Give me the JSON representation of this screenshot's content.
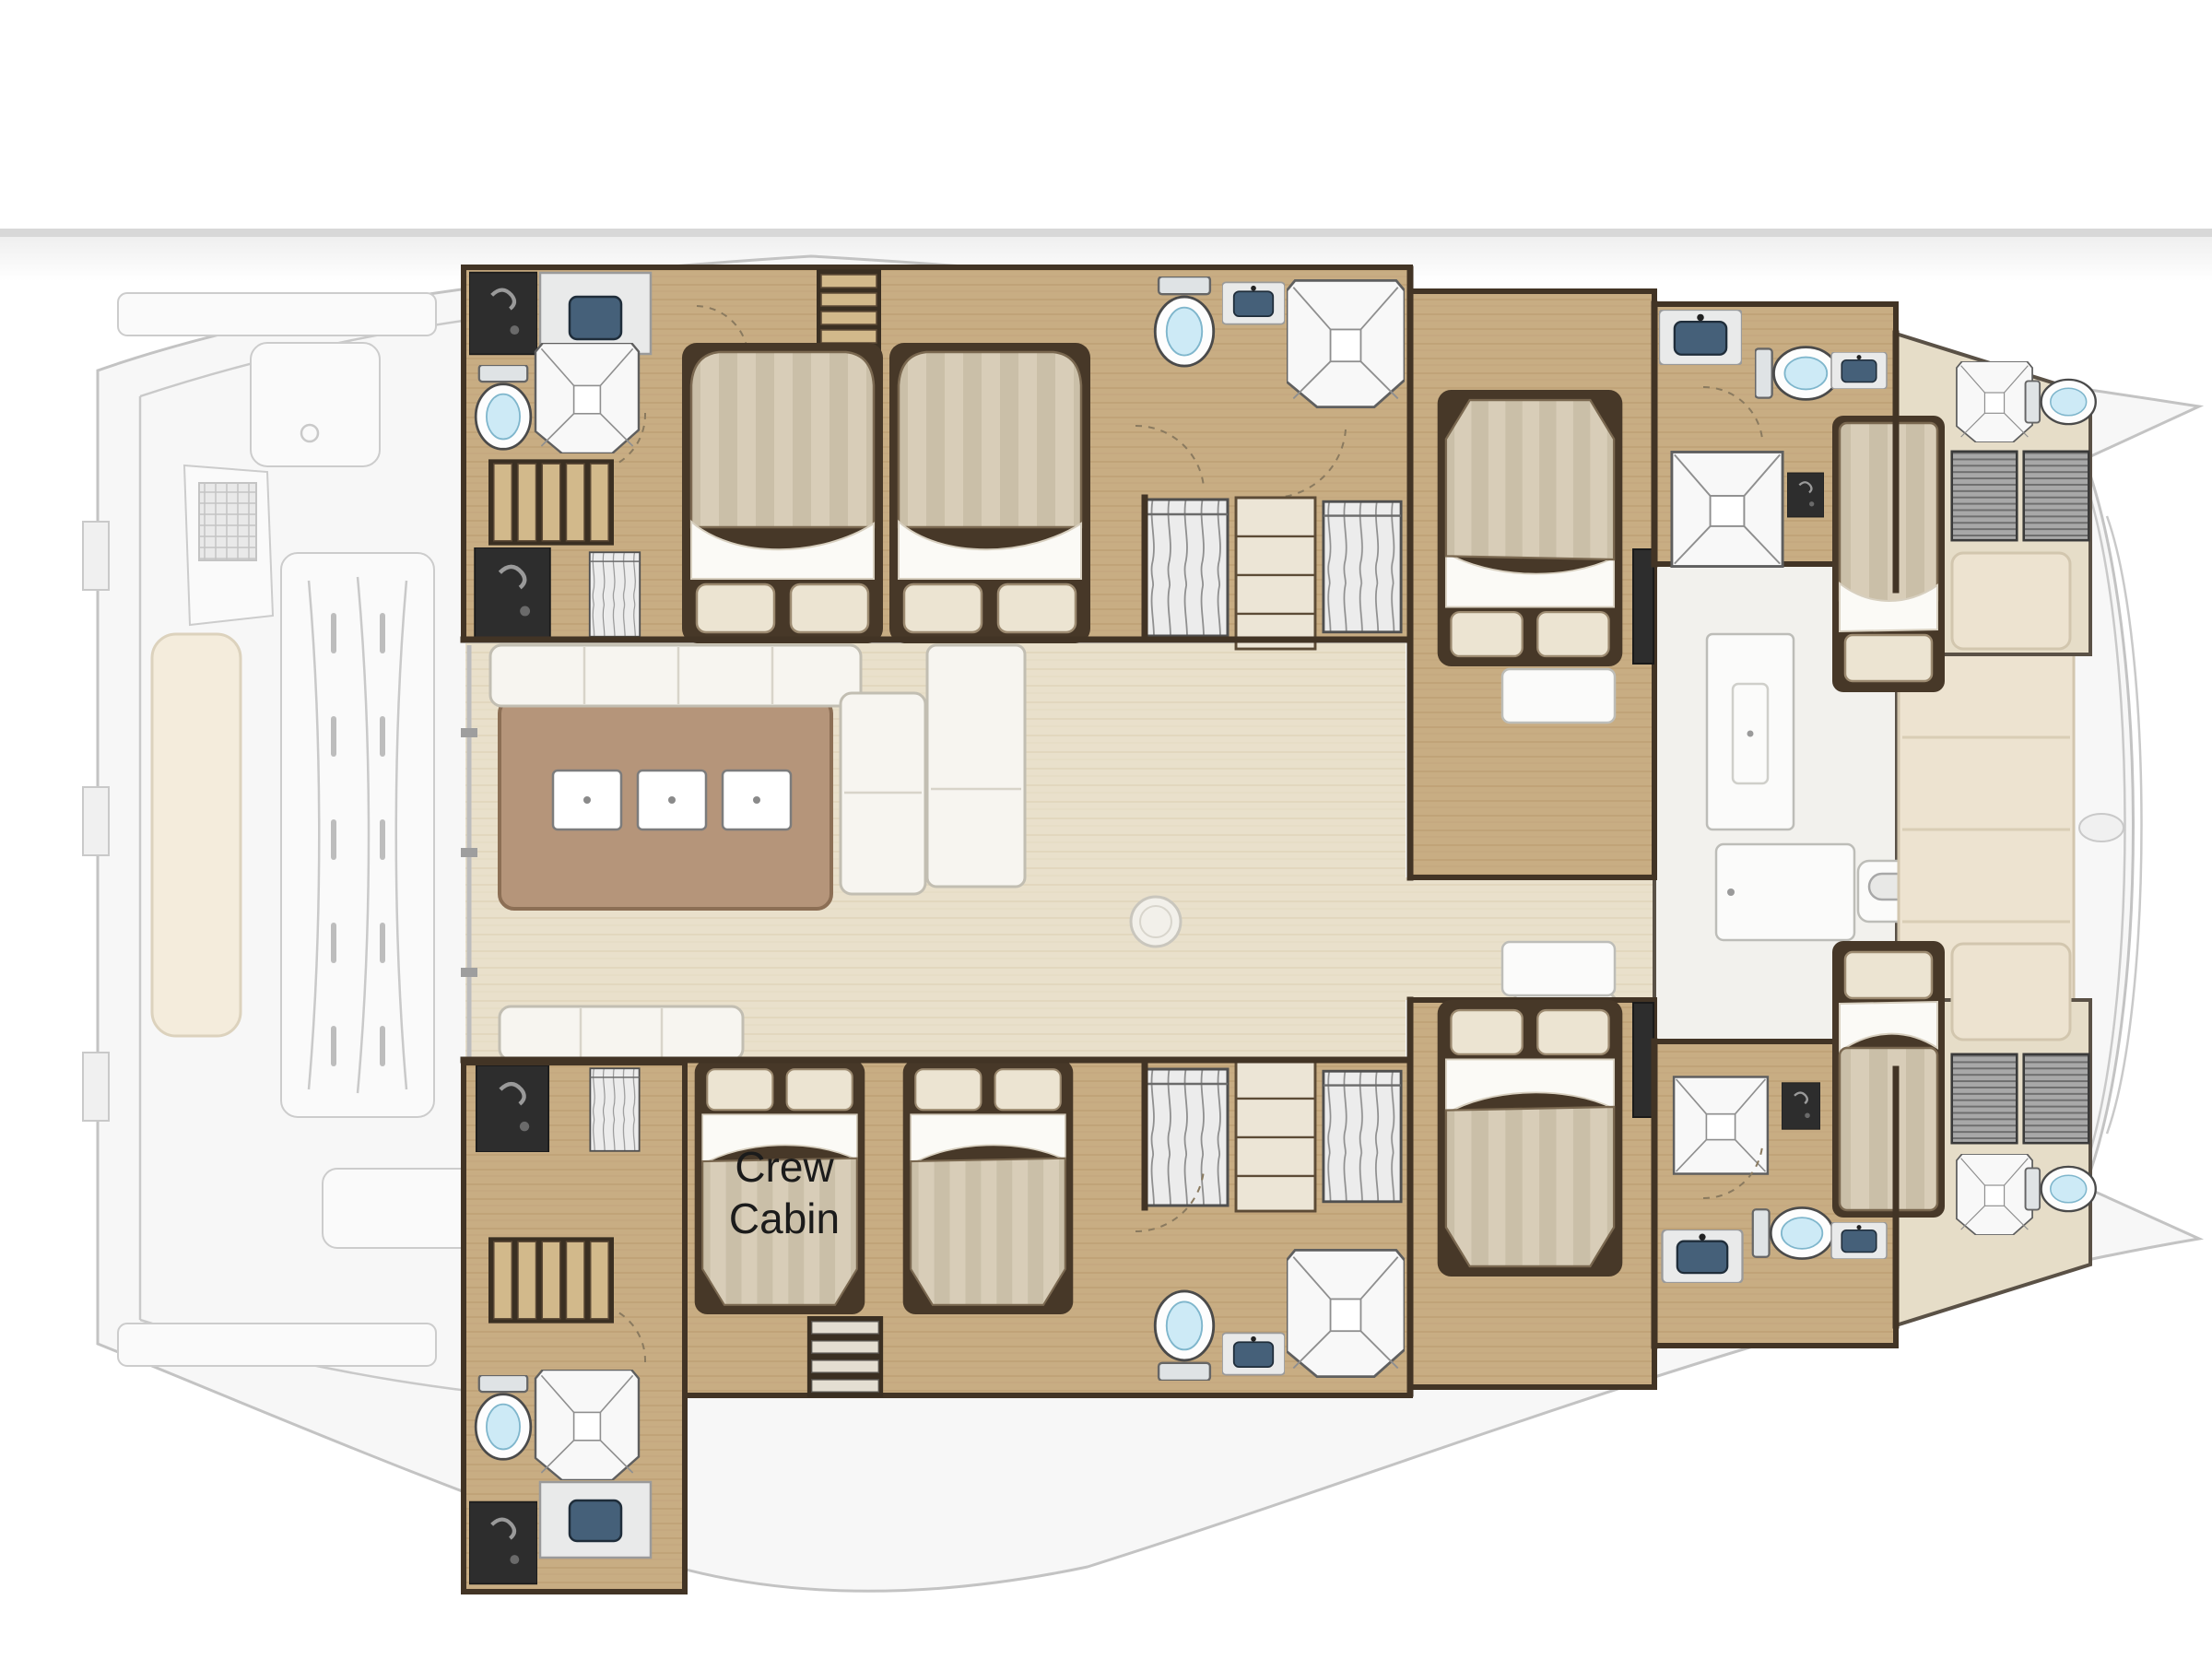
{
  "page": {
    "background": "#ffffff",
    "separator_color": "#d8d8d8"
  },
  "plan": {
    "vessel_type": "catamaran yacht floor plan",
    "labels": {
      "crew_cabin_line1": "Crew",
      "crew_cabin_line2": "Cabin"
    },
    "palette": {
      "hull_floor": "#c8ad83",
      "salon_floor": "#e9e0cb",
      "galley_island": "#b5957a",
      "walls": "#423425",
      "duvet_stripe_a": "#d8cdb8",
      "duvet_stripe_b": "#cabfa8",
      "pillow": "#ece4d2",
      "sink_basin": "#456079",
      "toilet_water": "#cdeaf6",
      "deck_faded": "#f7f7f7",
      "forward_cushion": "#ede3d0",
      "dark_locker": "#2d2d2d"
    },
    "inventory": {
      "salon": [
        "galley-island-with-3-sinks",
        "l-shaped-sofa",
        "chaise-longue",
        "aft-sofa",
        "round-side-table",
        "cool-box",
        "tall-cabinet",
        "forward-door-with-windlass",
        "lounge-chairs",
        "forward-cockpit-bench"
      ],
      "port_hull": [
        "aft-head-shower-wc-sink",
        "companionway-stairs",
        "dark-locker",
        "hanging-locker",
        "aft-double-bed",
        "mid-double-bed",
        "mid-head-shower-wc-sink",
        "wardrobe-and-shelves",
        "forward-double-bed",
        "ensuite-square-shower-wc-sinks",
        "forepeak-single-berth",
        "bow-head-shower-wc",
        "louvered-lockers",
        "bow-cushion"
      ],
      "starboard_hull": [
        "aft-head-shower-wc-sink",
        "companionway-stairs",
        "dark-locker",
        "hanging-locker",
        "crew-double-bed",
        "mid-double-bed",
        "mid-head-shower-wc-sink",
        "wardrobe-and-shelves",
        "forward-double-bed",
        "ensuite-square-shower-wc-sinks",
        "forepeak-single-berth",
        "bow-head-shower-wc",
        "louvered-lockers",
        "bow-cushion"
      ]
    }
  }
}
